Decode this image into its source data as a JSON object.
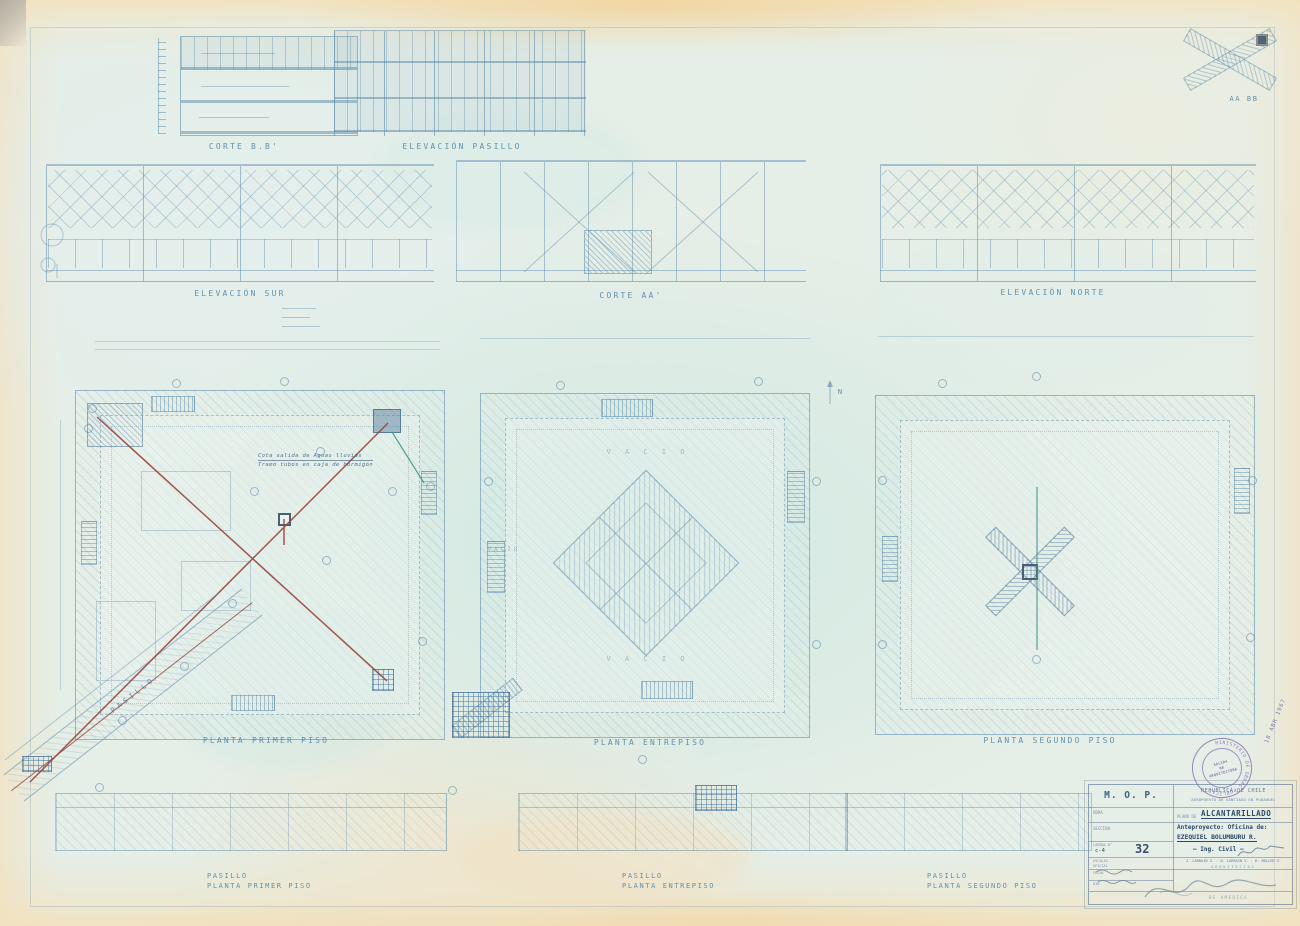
{
  "drawing_labels": {
    "corte_bb": "CORTE B.B'",
    "elevacion_pasillo": "ELEVACIÓN PASILLO",
    "elevacion_sur": "ELEVACIÓN SUR",
    "corte_aa": "CORTE AA'",
    "elevacion_norte": "ELEVACIÓN NORTE",
    "key_diagram": "AA BB",
    "planta_primer_piso": "PLANTA PRIMER PISO",
    "planta_entrepiso": "PLANTA ENTREPISO",
    "planta_segundo_piso": "PLANTA SEGUNDO PISO",
    "pasillo_diagonal": "PASILLO",
    "pasillo1_line1": "PASILLO",
    "pasillo1_line2": "PLANTA PRIMER PISO",
    "pasillo2_line1": "PASILLO",
    "pasillo2_line2": "PLANTA ENTREPISO",
    "pasillo3_line1": "PASILLO",
    "pasillo3_line2": "PLANTA SEGUNDO PISO",
    "vacio_top": "V A C I O",
    "vacio_left": "VACIO",
    "vacio_bottom": "V A C I O",
    "north": "N"
  },
  "annotations": {
    "note_line1": "Cota salida de Aguas lluvias",
    "note_line2": "Tramo tubos en caja de hormigón"
  },
  "title_block": {
    "agency": "M. O. P.",
    "country": "REPUBLICA DE CHILE",
    "project": "AEROPUERTO DE SANTIAGO EN PUDAHUEL",
    "obra_label": "OBRA",
    "plano_de": "PLANO DE",
    "plano_value": "ALCANTARILLADO",
    "seccion_label": "SECCION",
    "anteproyecto_line1": "Anteproyecto: Oficina  de:",
    "anteproyecto_line2": "EZEQUIEL BOLUMBURU R.",
    "ing_civil": "— Ing. Civil —",
    "lamina_label": "LAMINA N°",
    "lamina_code": "c-4",
    "lamina_numero": "32",
    "escala_label": "ESCALAS",
    "oficial_label": "OFICIAL",
    "fecha_label": "FECHA",
    "dib_label": "DIB.",
    "architects": "J. LARRAIN V. · D. LARRAIN V. · R. MULLER V.",
    "architects_title": "ARQUITECTOS",
    "footer_text": "DE AMERICA"
  },
  "stamp": {
    "ring_text": "MINISTERIO DE OBRAS PUBLICAS",
    "line1": "SALIDA",
    "line2": "DE",
    "line3": "ARQUITECTURA",
    "date": "18 ABR 1967"
  },
  "colors": {
    "ink_blue": "#6f9ab4",
    "pipe_red": "#97463e",
    "teal": "#3f9484",
    "stamp_purple": "#7b5fa0"
  }
}
